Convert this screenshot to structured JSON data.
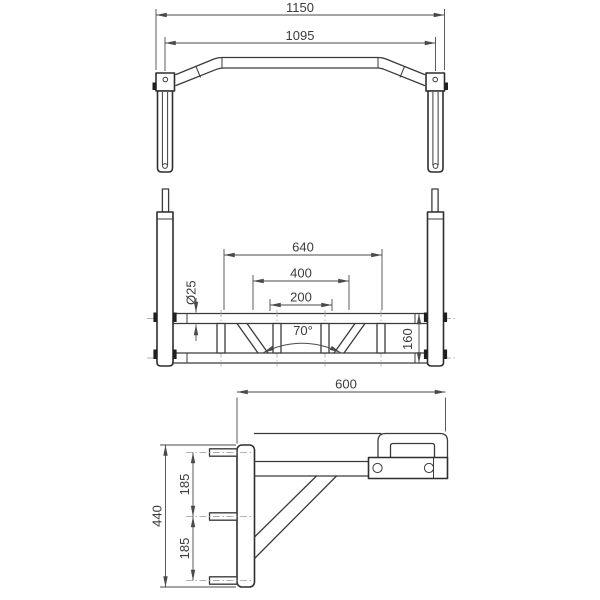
{
  "colors": {
    "background": "#ffffff",
    "object_lines": "#3b3b3b",
    "dimension_lines": "#4a4a4a",
    "centerlines": "#9a9a9a",
    "text": "#3b3b3b"
  },
  "views": {
    "top": {
      "dimensions": {
        "overall_width_mm": "1150",
        "bar_span_mm": "1095"
      }
    },
    "front": {
      "dimensions": {
        "frame_width_mm": "640",
        "mid_span_mm": "400",
        "grip_span_mm": "200",
        "tube_diameter": "Ø25",
        "brace_angle": "70°",
        "frame_height_mm": "160"
      }
    },
    "side": {
      "dimensions": {
        "reach_mm": "600",
        "plate_height_mm": "440",
        "bolt_spacing_upper_mm": "185",
        "bolt_spacing_lower_mm": "185"
      }
    }
  }
}
